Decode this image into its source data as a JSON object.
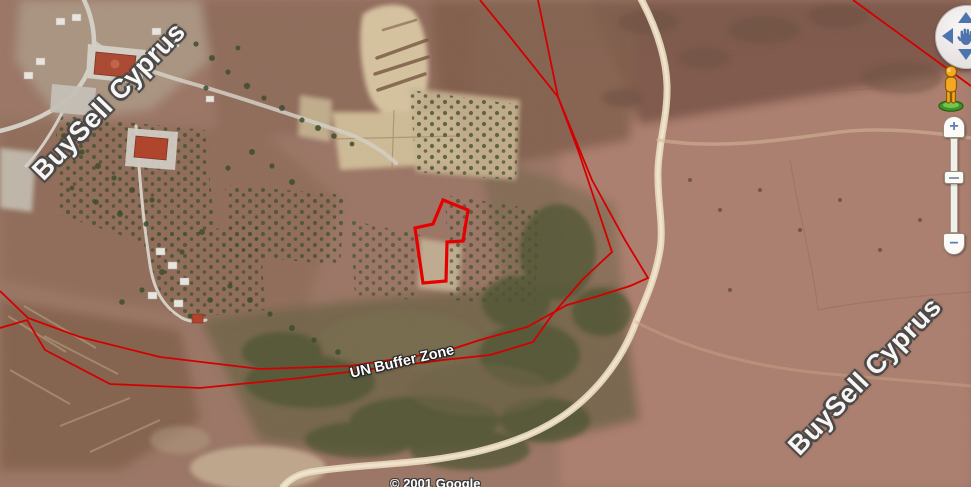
{
  "map": {
    "watermark_top_left": "BuySell Cyprus",
    "watermark_bottom_right": "BuySell Cyprus",
    "buffer_zone_label": "UN Buffer Zone",
    "attribution": "© 2001 Google",
    "colors": {
      "boundary_line": "#d40000",
      "property_outline": "#e60000",
      "terrain_base": "#9d7868",
      "sandy_path": "#ecdcc0"
    }
  },
  "controls": {
    "pan": {
      "up_icon": "chevron-up-icon",
      "down_icon": "chevron-down-icon",
      "left_icon": "chevron-left-icon",
      "right_icon": "chevron-right-icon",
      "center_icon": "hand-icon"
    },
    "pegman_icon": "street-view-pegman-icon",
    "zoom": {
      "zoom_in_label": "+",
      "zoom_out_label": "−"
    }
  }
}
